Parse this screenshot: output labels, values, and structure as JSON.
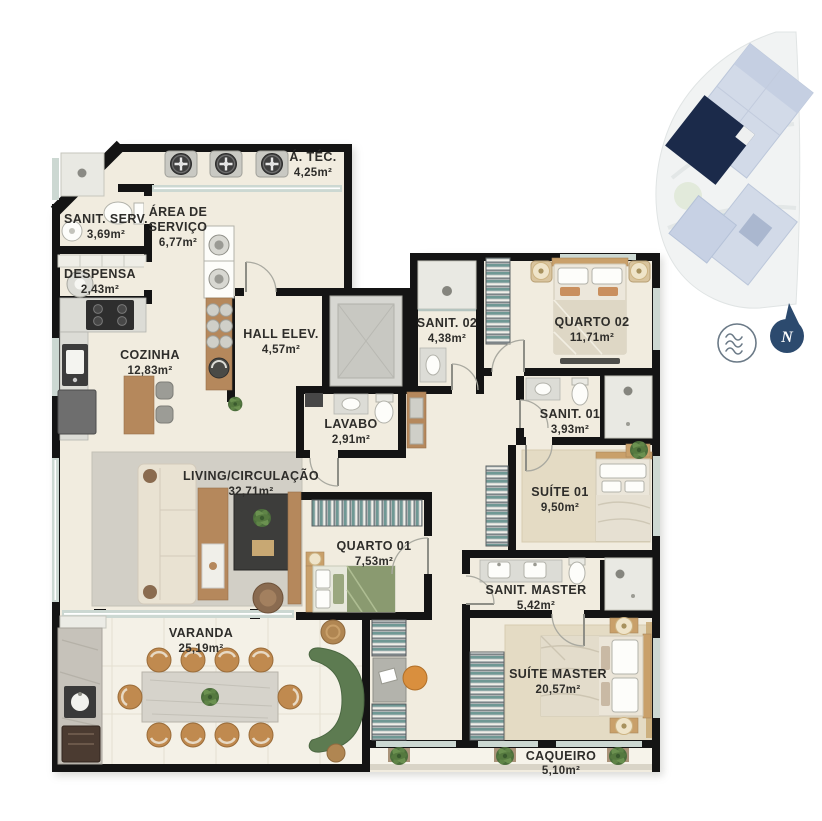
{
  "rooms": [
    {
      "name": "Á. TÉC.",
      "area": "4,25m²"
    },
    {
      "name": "SANIT. SERV.",
      "area": "3,69m²"
    },
    {
      "name": "ÁREA DE SERVIÇO",
      "name_line1": "ÁREA DE",
      "name_line2": "SERVIÇO",
      "area": "6,77m²"
    },
    {
      "name": "DESPENSA",
      "area": "2,43m²"
    },
    {
      "name": "COZINHA",
      "area": "12,83m²"
    },
    {
      "name": "HALL ELEV.",
      "area": "4,57m²"
    },
    {
      "name": "SANIT. 02",
      "area": "4,38m²"
    },
    {
      "name": "QUARTO 02",
      "area": "11,71m²"
    },
    {
      "name": "LAVABO",
      "area": "2,91m²"
    },
    {
      "name": "SANIT. 01",
      "area": "3,93m²"
    },
    {
      "name": "LIVING/CIRCULAÇÃO",
      "area": "32,71m²"
    },
    {
      "name": "SUÍTE 01",
      "area": "9,50m²"
    },
    {
      "name": "QUARTO 01",
      "area": "7,53m²"
    },
    {
      "name": "SANIT. MASTER",
      "area": "5,42m²"
    },
    {
      "name": "VARANDA",
      "area": "25,19m²"
    },
    {
      "name": "SUÍTE MASTER",
      "area": "20,57m²"
    },
    {
      "name": "CAQUEIRO",
      "area": "5,10m²"
    }
  ],
  "compass": {
    "label": "N",
    "color": "#2c4a6e"
  },
  "icons": {
    "waves_icon": "circle-with-three-wavy-lines",
    "compass_icon": "north-arrow-with-N"
  },
  "colors": {
    "wall": "#141414",
    "floor": "#f1ecdf",
    "varanda_floor": "#f4f1e7",
    "rug": "#d2cfc6",
    "carpet": "#e4dbc4",
    "wood": "#b5885c",
    "greenery": "#5c7a50",
    "textile_teal": "#6f9894",
    "highlight_navy": "#1b2a4a",
    "keyplan_building": "#d2dae8"
  }
}
